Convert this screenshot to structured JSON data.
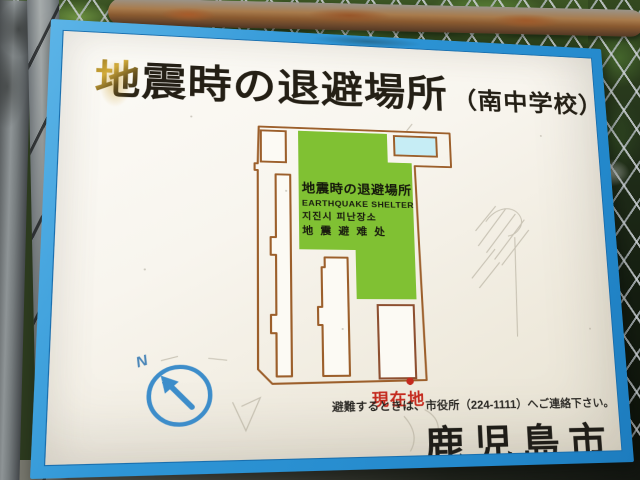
{
  "scene": {
    "description_elements": [
      "chain-link-fence",
      "foliage",
      "rusty-rail",
      "metal-pole",
      "concrete-post"
    ]
  },
  "sign": {
    "title_first": "地",
    "title_rest": "震時の退避場所",
    "title_suffix": "（南中学校）",
    "map": {
      "shelter_label_ja": "地震時の退避場所",
      "shelter_label_en": "EARTHQUAKE SHELTER",
      "shelter_label_ko": "지진시 피난장소",
      "shelter_label_zh": "地 震 避 难 处",
      "you_are_here": "現在地"
    },
    "compass": {
      "north_label": "N"
    },
    "notice": "避難するときは、市役所（224-1111）へご連絡下さい。",
    "city": "鹿児島市",
    "colors": {
      "frame_blue": "#2f96d6",
      "map_outline": "#9c5f2b",
      "building_outline_dark": "#8d4f30",
      "field_green": "#80c133",
      "pool_cyan": "#c6edf5",
      "marker_red": "#c42a1e",
      "compass_blue": "#3d8dca",
      "stain_gold": "#d2ab3a"
    }
  }
}
